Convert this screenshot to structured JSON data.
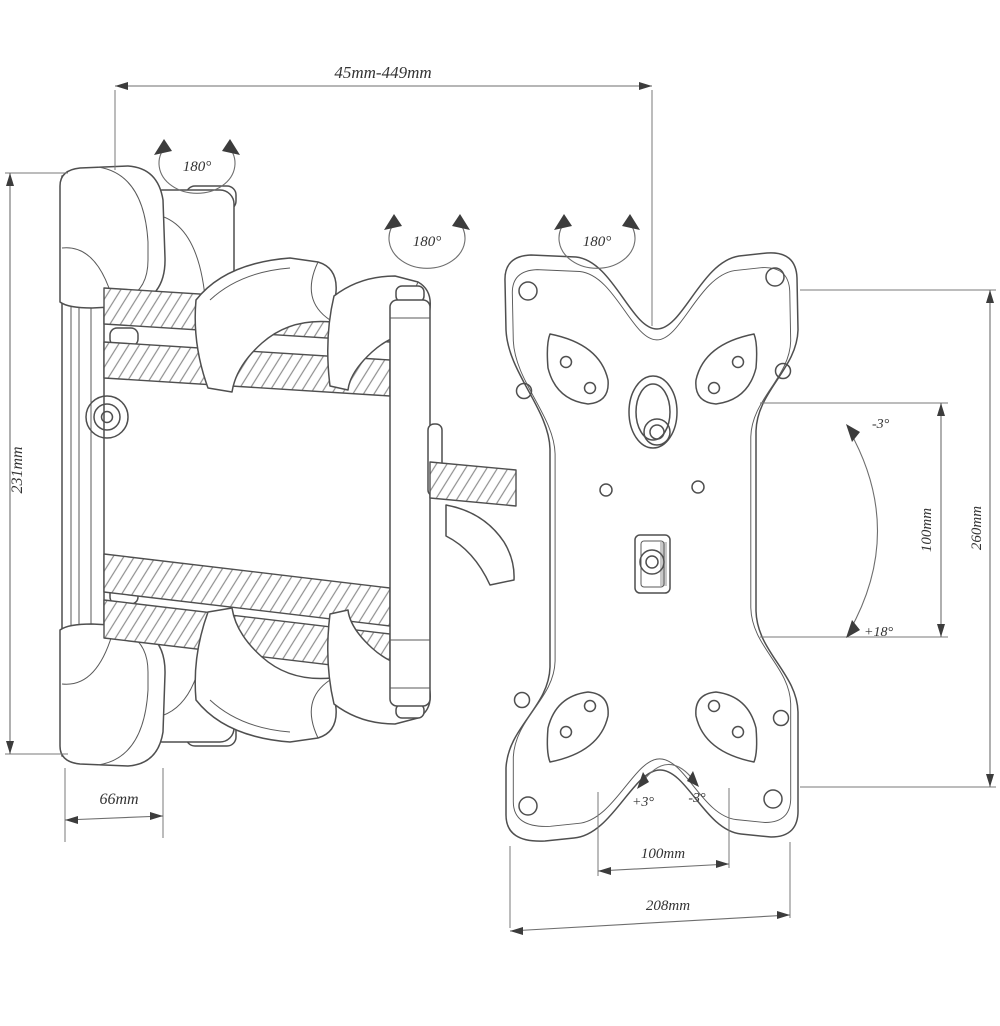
{
  "drawing_title": "Articulating TV wall mount technical drawing",
  "dimensions": {
    "extension_range": "45mm-449mm",
    "bracket_height": "231mm",
    "wall_plate_width": "66mm",
    "vesa_vertical": "100mm",
    "plate_height": "260mm",
    "vesa_horizontal": "100mm",
    "plate_width": "208mm"
  },
  "angles": {
    "swivel": [
      "180°",
      "180°",
      "180°"
    ],
    "tilt_top": "-3°",
    "tilt_bottom": "+18°",
    "level_left": "+3°",
    "level_right": "-3°"
  },
  "colors": {
    "line": "#4f4f4f",
    "dimension_line": "#6e6e6e",
    "text": "#333333",
    "background": "#ffffff"
  }
}
